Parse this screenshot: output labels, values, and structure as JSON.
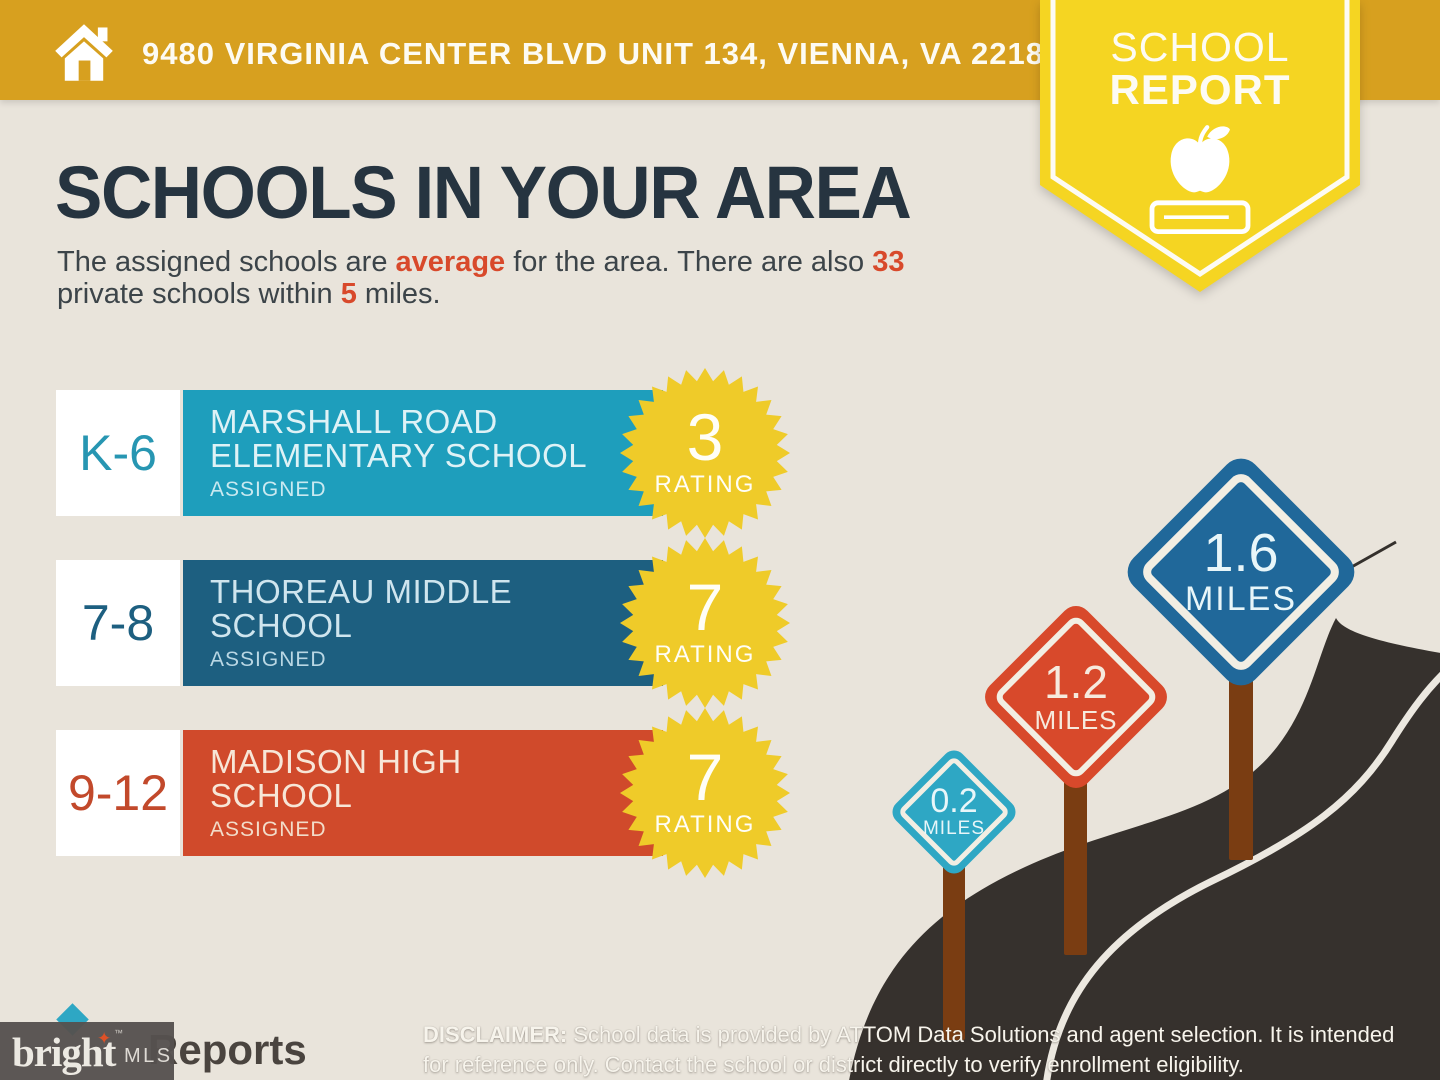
{
  "colors": {
    "banner_gold": "#D7A01F",
    "badge_yellow": "#F5D522",
    "background_cream": "#E9E4DB",
    "heading_navy": "#263440",
    "accent_red": "#D8492B",
    "starburst_yellow": "#EFCB29",
    "road_dark": "#36312D",
    "post_brown": "#7A3D12"
  },
  "header": {
    "address": "9480 VIRGINIA CENTER BLVD UNIT 134, VIENNA, VA 22181",
    "badge_line1": "SCHOOL",
    "badge_line2": "REPORT"
  },
  "main": {
    "title": "SCHOOLS IN YOUR AREA",
    "subtitle": {
      "p1": "The assigned schools are ",
      "h1": "average",
      "p2": " for the area. There are also ",
      "h2": "33",
      "p3": "private schools within ",
      "h3": "5",
      "p4": " miles."
    }
  },
  "schools": {
    "rating_label": "RATING",
    "assigned_label": "ASSIGNED",
    "rows": [
      {
        "grade": "K-6",
        "name_lines": [
          "MARSHALL ROAD",
          "ELEMENTARY SCHOOL"
        ],
        "rating": "3",
        "bar_color": "#1E9EBC"
      },
      {
        "grade": "7-8",
        "name_lines": [
          "THOREAU MIDDLE",
          "SCHOOL"
        ],
        "rating": "7",
        "bar_color": "#1D5F80"
      },
      {
        "grade": "9-12",
        "name_lines": [
          "MADISON HIGH",
          "SCHOOL"
        ],
        "rating": "7",
        "bar_color": "#D04A2B"
      }
    ]
  },
  "distance_signs": [
    {
      "value": "0.2",
      "unit": "MILES",
      "color": "#2EA7C4"
    },
    {
      "value": "1.2",
      "unit": "MILES",
      "color": "#D8492B"
    },
    {
      "value": "1.6",
      "unit": "MILES",
      "color": "#20689A"
    }
  ],
  "footer": {
    "brand": "bright",
    "brand_tm": "™",
    "brand_suffix": "MLS",
    "brand_star_glyph": "✦",
    "partial_logo_text": "Reports",
    "disclaimer_label": "DISCLAIMER:",
    "disclaimer_line1_rest": " School data is provided by ATTOM Data Solutions and agent selection. It is intended",
    "disclaimer_line2": "for reference only. Contact the school or district directly to verify enrollment eligibility."
  }
}
